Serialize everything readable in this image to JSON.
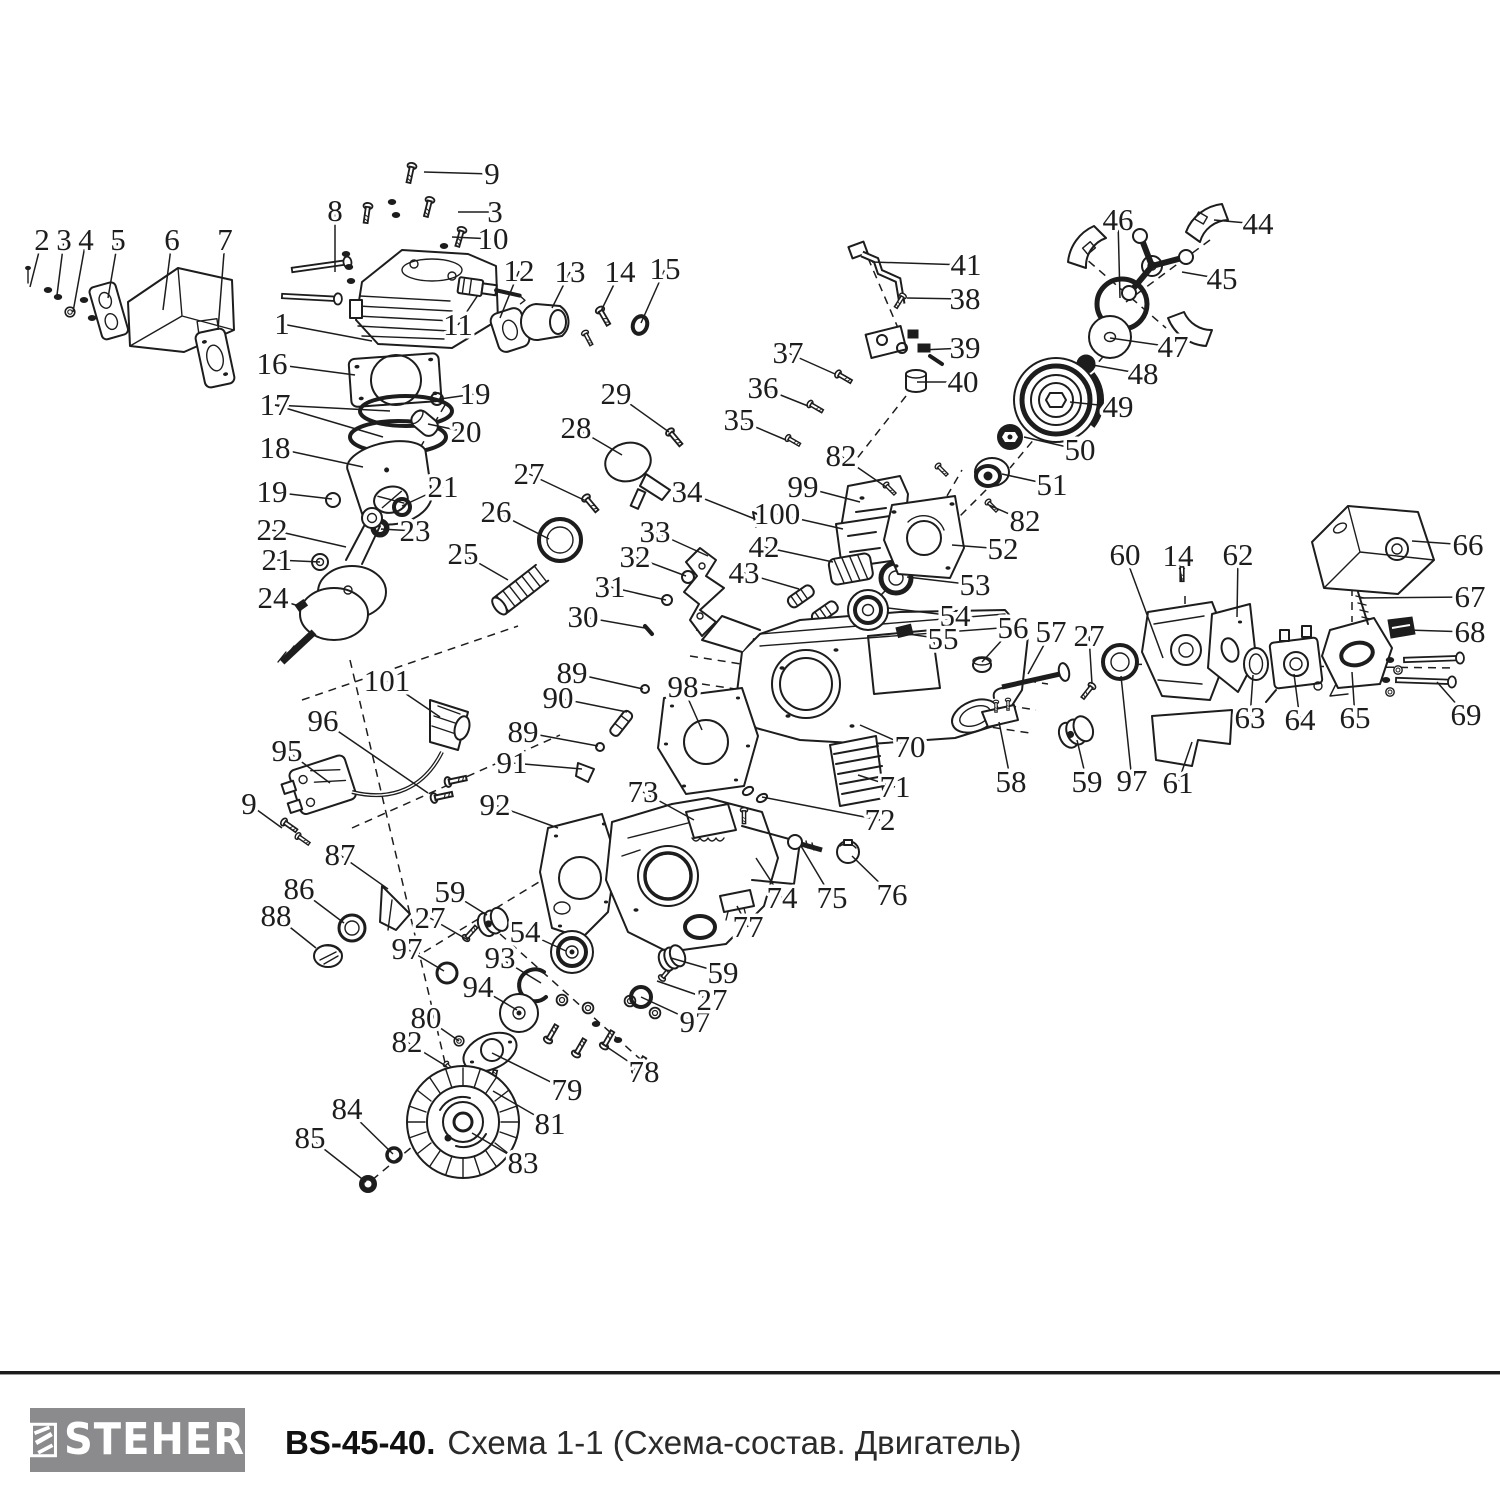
{
  "footer": {
    "brand": "STEHER",
    "model": "BS-45-40.",
    "scheme": "Схема 1-1 (Схема-состав. Двигатель)"
  },
  "colors": {
    "ink": "#1d1d1d",
    "logo_bg": "#8b8b8d",
    "logo_fg": "#ffffff"
  },
  "diagram": {
    "dashes": [
      [
        1210,
        240,
        1126,
        302
      ],
      [
        1078,
        252,
        1166,
        328
      ],
      [
        1122,
        334,
        1010,
        468
      ],
      [
        996,
        480,
        880,
        596
      ],
      [
        906,
        396,
        848,
        470
      ],
      [
        868,
        258,
        898,
        328
      ],
      [
        696,
        630,
        1048,
        684
      ],
      [
        690,
        656,
        1036,
        710
      ],
      [
        702,
        684,
        1030,
        733
      ],
      [
        1106,
        664,
        1456,
        668
      ],
      [
        1185,
        596,
        1185,
        638
      ],
      [
        302,
        700,
        518,
        626
      ],
      [
        352,
        828,
        560,
        735
      ],
      [
        424,
        952,
        562,
        868
      ],
      [
        445,
        405,
        420,
        448
      ],
      [
        350,
        660,
        455,
        1105
      ],
      [
        500,
        934,
        648,
        1066
      ],
      [
        1352,
        588,
        1352,
        622
      ],
      [
        940,
        508,
        962,
        470
      ],
      [
        372,
        1180,
        430,
        1132
      ]
    ],
    "labels": [
      {
        "t": "2",
        "x": 42,
        "y": 240,
        "l": [
          [
            30,
            287
          ]
        ]
      },
      {
        "t": "3",
        "x": 64,
        "y": 240,
        "l": [
          [
            57,
            295
          ]
        ]
      },
      {
        "t": "4",
        "x": 86,
        "y": 240,
        "l": [
          [
            73,
            312
          ]
        ]
      },
      {
        "t": "5",
        "x": 118,
        "y": 240,
        "l": [
          [
            108,
            298
          ]
        ]
      },
      {
        "t": "6",
        "x": 172,
        "y": 240,
        "l": [
          [
            163,
            310
          ]
        ]
      },
      {
        "t": "7",
        "x": 225,
        "y": 240,
        "l": [
          [
            218,
            330
          ]
        ]
      },
      {
        "t": "8",
        "x": 335,
        "y": 211,
        "l": [
          [
            335,
            272
          ]
        ]
      },
      {
        "t": "9",
        "x": 492,
        "y": 174,
        "l": [
          [
            424,
            172
          ]
        ]
      },
      {
        "t": "3",
        "x": 495,
        "y": 212,
        "l": [
          [
            458,
            212
          ]
        ]
      },
      {
        "t": "10",
        "x": 493,
        "y": 239,
        "l": [
          [
            452,
            237
          ]
        ]
      },
      {
        "t": "1",
        "x": 282,
        "y": 324,
        "l": [
          [
            372,
            341
          ]
        ]
      },
      {
        "t": "11",
        "x": 458,
        "y": 325,
        "l": [
          [
            478,
            295
          ]
        ]
      },
      {
        "t": "12",
        "x": 519,
        "y": 271,
        "l": [
          [
            500,
            318
          ]
        ]
      },
      {
        "t": "13",
        "x": 570,
        "y": 272,
        "l": [
          [
            552,
            308
          ]
        ]
      },
      {
        "t": "14",
        "x": 620,
        "y": 272,
        "l": [
          [
            601,
            311
          ]
        ]
      },
      {
        "t": "15",
        "x": 665,
        "y": 269,
        "l": [
          [
            641,
            323
          ]
        ]
      },
      {
        "t": "16",
        "x": 272,
        "y": 364,
        "l": [
          [
            355,
            375
          ]
        ]
      },
      {
        "t": "17",
        "x": 275,
        "y": 405,
        "l": [
          [
            390,
            411
          ],
          [
            383,
            437
          ]
        ]
      },
      {
        "t": "18",
        "x": 275,
        "y": 448,
        "l": [
          [
            363,
            467
          ]
        ]
      },
      {
        "t": "19",
        "x": 272,
        "y": 492,
        "l": [
          [
            332,
            499
          ]
        ]
      },
      {
        "t": "19",
        "x": 475,
        "y": 394,
        "l": [
          [
            440,
            399
          ]
        ]
      },
      {
        "t": "20",
        "x": 466,
        "y": 432,
        "l": [
          [
            428,
            424
          ]
        ]
      },
      {
        "t": "21",
        "x": 443,
        "y": 487,
        "l": [
          [
            402,
            506
          ]
        ]
      },
      {
        "t": "22",
        "x": 272,
        "y": 530,
        "l": [
          [
            346,
            547
          ]
        ]
      },
      {
        "t": "23",
        "x": 415,
        "y": 531,
        "l": [
          [
            381,
            529
          ]
        ]
      },
      {
        "t": "21",
        "x": 277,
        "y": 560,
        "l": [
          [
            320,
            562
          ]
        ]
      },
      {
        "t": "24",
        "x": 273,
        "y": 598,
        "l": [
          [
            299,
            606
          ]
        ]
      },
      {
        "t": "25",
        "x": 463,
        "y": 554,
        "l": [
          [
            508,
            580
          ]
        ]
      },
      {
        "t": "26",
        "x": 496,
        "y": 512,
        "l": [
          [
            549,
            539
          ]
        ]
      },
      {
        "t": "27",
        "x": 529,
        "y": 474,
        "l": [
          [
            584,
            500
          ]
        ]
      },
      {
        "t": "28",
        "x": 576,
        "y": 428,
        "l": [
          [
            622,
            455
          ]
        ]
      },
      {
        "t": "29",
        "x": 616,
        "y": 394,
        "l": [
          [
            669,
            432
          ]
        ]
      },
      {
        "t": "30",
        "x": 583,
        "y": 617,
        "l": [
          [
            645,
            628
          ]
        ]
      },
      {
        "t": "31",
        "x": 610,
        "y": 587,
        "l": [
          [
            666,
            600
          ]
        ]
      },
      {
        "t": "32",
        "x": 635,
        "y": 557,
        "l": [
          [
            686,
            576
          ]
        ]
      },
      {
        "t": "33",
        "x": 655,
        "y": 532,
        "l": [
          [
            708,
            556
          ]
        ]
      },
      {
        "t": "34",
        "x": 687,
        "y": 492,
        "l": [
          [
            755,
            519
          ]
        ]
      },
      {
        "t": "35",
        "x": 739,
        "y": 420,
        "l": [
          [
            786,
            440
          ]
        ]
      },
      {
        "t": "36",
        "x": 763,
        "y": 388,
        "l": [
          [
            808,
            406
          ]
        ]
      },
      {
        "t": "37",
        "x": 788,
        "y": 353,
        "l": [
          [
            835,
            374
          ]
        ]
      },
      {
        "t": "38",
        "x": 965,
        "y": 299,
        "l": [
          [
            907,
            298
          ]
        ]
      },
      {
        "t": "39",
        "x": 965,
        "y": 348,
        "l": [
          [
            921,
            350
          ]
        ]
      },
      {
        "t": "40",
        "x": 963,
        "y": 382,
        "l": [
          [
            917,
            382
          ]
        ]
      },
      {
        "t": "41",
        "x": 966,
        "y": 265,
        "l": [
          [
            872,
            262
          ]
        ]
      },
      {
        "t": "42",
        "x": 764,
        "y": 547,
        "l": [
          [
            833,
            562
          ]
        ]
      },
      {
        "t": "43",
        "x": 744,
        "y": 573,
        "l": [
          [
            799,
            589
          ]
        ]
      },
      {
        "t": "44",
        "x": 1258,
        "y": 224,
        "l": [
          [
            1214,
            220
          ]
        ]
      },
      {
        "t": "45",
        "x": 1222,
        "y": 279,
        "l": [
          [
            1182,
            272
          ]
        ]
      },
      {
        "t": "46",
        "x": 1118,
        "y": 220,
        "l": [
          [
            1120,
            298
          ]
        ]
      },
      {
        "t": "47",
        "x": 1173,
        "y": 347,
        "l": [
          [
            1110,
            338
          ]
        ]
      },
      {
        "t": "48",
        "x": 1143,
        "y": 374,
        "l": [
          [
            1087,
            364
          ]
        ]
      },
      {
        "t": "49",
        "x": 1118,
        "y": 407,
        "l": [
          [
            1070,
            402
          ]
        ]
      },
      {
        "t": "50",
        "x": 1080,
        "y": 450,
        "l": [
          [
            1024,
            437
          ]
        ]
      },
      {
        "t": "51",
        "x": 1052,
        "y": 485,
        "l": [
          [
            1002,
            474
          ]
        ]
      },
      {
        "t": "82",
        "x": 1025,
        "y": 521,
        "l": [
          [
            989,
            505
          ]
        ]
      },
      {
        "t": "82",
        "x": 841,
        "y": 456,
        "l": [
          [
            886,
            487
          ]
        ]
      },
      {
        "t": "99",
        "x": 803,
        "y": 487,
        "l": [
          [
            860,
            502
          ]
        ]
      },
      {
        "t": "100",
        "x": 777,
        "y": 514,
        "l": [
          [
            843,
            529
          ]
        ]
      },
      {
        "t": "52",
        "x": 1003,
        "y": 549,
        "l": [
          [
            952,
            545
          ]
        ]
      },
      {
        "t": "53",
        "x": 975,
        "y": 585,
        "l": [
          [
            907,
            577
          ]
        ]
      },
      {
        "t": "54",
        "x": 955,
        "y": 616,
        "l": [
          [
            888,
            608
          ]
        ]
      },
      {
        "t": "55",
        "x": 943,
        "y": 639,
        "l": [
          [
            901,
            633
          ]
        ]
      },
      {
        "t": "56",
        "x": 1013,
        "y": 628,
        "l": [
          [
            982,
            662
          ]
        ]
      },
      {
        "t": "57",
        "x": 1051,
        "y": 632,
        "l": [
          [
            1028,
            674
          ]
        ]
      },
      {
        "t": "27",
        "x": 1089,
        "y": 636,
        "l": [
          [
            1092,
            684
          ]
        ]
      },
      {
        "t": "58",
        "x": 1011,
        "y": 782,
        "l": [
          [
            999,
            722
          ]
        ]
      },
      {
        "t": "59",
        "x": 1087,
        "y": 782,
        "l": [
          [
            1077,
            740
          ]
        ]
      },
      {
        "t": "97",
        "x": 1132,
        "y": 781,
        "l": [
          [
            1121,
            676
          ]
        ]
      },
      {
        "t": "61",
        "x": 1178,
        "y": 783,
        "l": [
          [
            1192,
            742
          ]
        ]
      },
      {
        "t": "60",
        "x": 1125,
        "y": 555,
        "l": [
          [
            1163,
            658
          ]
        ]
      },
      {
        "t": "14",
        "x": 1178,
        "y": 556,
        "l": [
          [
            1182,
            582
          ]
        ]
      },
      {
        "t": "62",
        "x": 1238,
        "y": 555,
        "l": [
          [
            1237,
            617
          ]
        ]
      },
      {
        "t": "66",
        "x": 1468,
        "y": 545,
        "l": [
          [
            1412,
            541
          ]
        ]
      },
      {
        "t": "67",
        "x": 1470,
        "y": 597,
        "l": [
          [
            1360,
            598
          ]
        ]
      },
      {
        "t": "68",
        "x": 1470,
        "y": 632,
        "l": [
          [
            1407,
            630
          ]
        ]
      },
      {
        "t": "69",
        "x": 1466,
        "y": 715,
        "l": [
          [
            1437,
            682
          ]
        ]
      },
      {
        "t": "63",
        "x": 1250,
        "y": 718,
        "l": [
          [
            1253,
            675
          ]
        ]
      },
      {
        "t": "64",
        "x": 1300,
        "y": 720,
        "l": [
          [
            1294,
            674
          ]
        ]
      },
      {
        "t": "65",
        "x": 1355,
        "y": 718,
        "l": [
          [
            1352,
            672
          ]
        ]
      },
      {
        "t": "70",
        "x": 910,
        "y": 747,
        "l": [
          [
            860,
            725
          ]
        ]
      },
      {
        "t": "71",
        "x": 895,
        "y": 787,
        "l": [
          [
            858,
            775
          ]
        ]
      },
      {
        "t": "72",
        "x": 880,
        "y": 820,
        "l": [
          [
            762,
            797
          ]
        ]
      },
      {
        "t": "73",
        "x": 643,
        "y": 792,
        "l": [
          [
            694,
            820
          ]
        ]
      },
      {
        "t": "74",
        "x": 782,
        "y": 898,
        "l": [
          [
            756,
            858
          ]
        ]
      },
      {
        "t": "75",
        "x": 832,
        "y": 898,
        "l": [
          [
            801,
            846
          ]
        ]
      },
      {
        "t": "76",
        "x": 892,
        "y": 895,
        "l": [
          [
            852,
            856
          ]
        ]
      },
      {
        "t": "77",
        "x": 748,
        "y": 927,
        "l": [
          [
            737,
            906
          ]
        ]
      },
      {
        "t": "89",
        "x": 572,
        "y": 673,
        "l": [
          [
            643,
            689
          ]
        ]
      },
      {
        "t": "90",
        "x": 558,
        "y": 698,
        "l": [
          [
            627,
            712
          ]
        ]
      },
      {
        "t": "98",
        "x": 683,
        "y": 687,
        "l": [
          [
            702,
            730
          ]
        ]
      },
      {
        "t": "89",
        "x": 523,
        "y": 732,
        "l": [
          [
            598,
            746
          ]
        ]
      },
      {
        "t": "91",
        "x": 512,
        "y": 763,
        "l": [
          [
            582,
            769
          ]
        ]
      },
      {
        "t": "92",
        "x": 495,
        "y": 805,
        "l": [
          [
            558,
            828
          ]
        ]
      },
      {
        "t": "101",
        "x": 387,
        "y": 681,
        "l": [
          [
            440,
            717
          ]
        ]
      },
      {
        "t": "96",
        "x": 323,
        "y": 721,
        "l": [
          [
            428,
            793
          ]
        ]
      },
      {
        "t": "95",
        "x": 287,
        "y": 751,
        "l": [
          [
            330,
            783
          ]
        ]
      },
      {
        "t": "9",
        "x": 249,
        "y": 804,
        "l": [
          [
            282,
            828
          ]
        ]
      },
      {
        "t": "87",
        "x": 340,
        "y": 855,
        "l": [
          [
            388,
            889
          ]
        ]
      },
      {
        "t": "86",
        "x": 299,
        "y": 889,
        "l": [
          [
            344,
            923
          ]
        ]
      },
      {
        "t": "88",
        "x": 276,
        "y": 916,
        "l": [
          [
            316,
            948
          ]
        ]
      },
      {
        "t": "59",
        "x": 450,
        "y": 892,
        "l": [
          [
            487,
            915
          ]
        ]
      },
      {
        "t": "27",
        "x": 430,
        "y": 918,
        "l": [
          [
            468,
            940
          ]
        ]
      },
      {
        "t": "97",
        "x": 407,
        "y": 949,
        "l": [
          [
            444,
            971
          ]
        ]
      },
      {
        "t": "54",
        "x": 525,
        "y": 932,
        "l": [
          [
            566,
            951
          ]
        ]
      },
      {
        "t": "93",
        "x": 500,
        "y": 958,
        "l": [
          [
            541,
            983
          ]
        ]
      },
      {
        "t": "94",
        "x": 478,
        "y": 987,
        "l": [
          [
            517,
            1010
          ]
        ]
      },
      {
        "t": "80",
        "x": 426,
        "y": 1018,
        "l": [
          [
            459,
            1041
          ]
        ]
      },
      {
        "t": "82",
        "x": 407,
        "y": 1042,
        "l": [
          [
            446,
            1066
          ]
        ]
      },
      {
        "t": "79",
        "x": 567,
        "y": 1090,
        "l": [
          [
            492,
            1053
          ]
        ]
      },
      {
        "t": "81",
        "x": 550,
        "y": 1124,
        "l": [
          [
            493,
            1091
          ]
        ]
      },
      {
        "t": "78",
        "x": 644,
        "y": 1072,
        "l": [
          [
            601,
            1043
          ]
        ]
      },
      {
        "t": "97",
        "x": 695,
        "y": 1022,
        "l": [
          [
            641,
            997
          ]
        ]
      },
      {
        "t": "27",
        "x": 712,
        "y": 1000,
        "l": [
          [
            657,
            981
          ]
        ]
      },
      {
        "t": "59",
        "x": 723,
        "y": 973,
        "l": [
          [
            671,
            958
          ]
        ]
      },
      {
        "t": "83",
        "x": 523,
        "y": 1163,
        "l": [
          [
            472,
            1133
          ]
        ]
      },
      {
        "t": "84",
        "x": 347,
        "y": 1109,
        "l": [
          [
            393,
            1154
          ]
        ]
      },
      {
        "t": "85",
        "x": 310,
        "y": 1138,
        "l": [
          [
            366,
            1182
          ]
        ]
      }
    ]
  }
}
